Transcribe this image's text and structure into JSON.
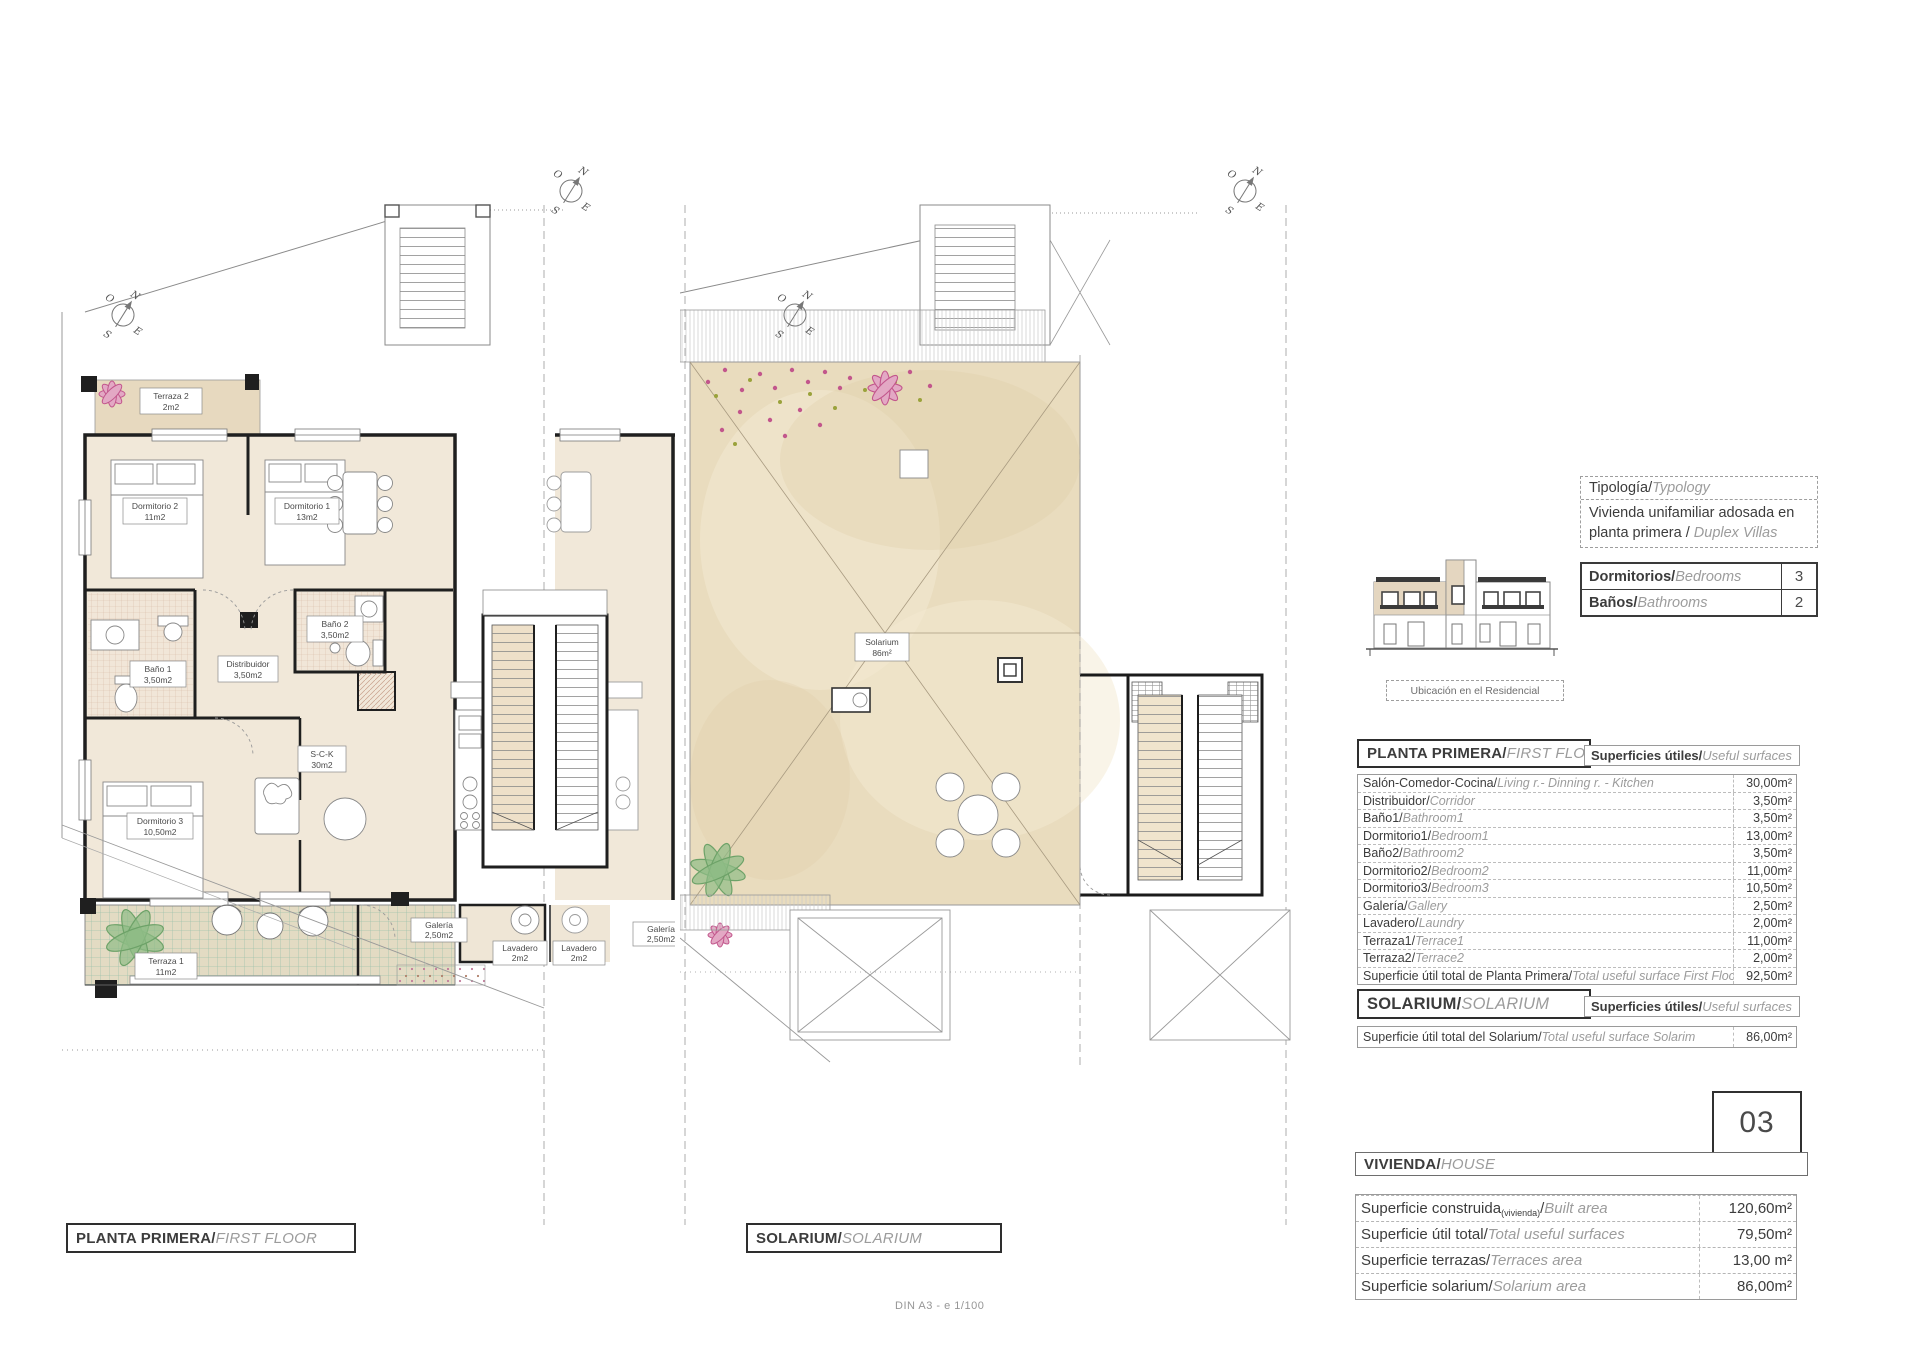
{
  "sheet": {
    "scale_note": "DIN A3 - e 1/100"
  },
  "compass": {
    "n": "N",
    "s": "S",
    "e": "E",
    "o": "O"
  },
  "plan1": {
    "title_es": "PLANTA PRIMERA/",
    "title_en": "FIRST FLOOR",
    "rooms": [
      {
        "name": "Terraza 2",
        "area": "2m2"
      },
      {
        "name": "Dormitorio 2",
        "area": "11m2"
      },
      {
        "name": "Dormitorio 1",
        "area": "13m2"
      },
      {
        "name": "Baño 1",
        "area": "3,50m2"
      },
      {
        "name": "Distribuidor",
        "area": "3,50m2"
      },
      {
        "name": "Baño 2",
        "area": "3,50m2"
      },
      {
        "name": "Dormitorio 3",
        "area": "10,50m2"
      },
      {
        "name": "S-C-K",
        "area": "30m2"
      },
      {
        "name": "Terraza 1",
        "area": "11m2"
      },
      {
        "name": "Galería",
        "area": "2,50m2"
      },
      {
        "name": "Lavadero",
        "area": "2m2"
      },
      {
        "name": "Lavadero",
        "area": "2m2"
      },
      {
        "name": "Galería",
        "area": "2,50m2"
      }
    ]
  },
  "plan2": {
    "title_es": "SOLARIUM/",
    "title_en": "SOLARIUM",
    "label_name": "Solarium",
    "label_area": "86m²"
  },
  "typology": {
    "header_es": "Tipología/",
    "header_en": "Typology",
    "line1": "Vivienda unifamiliar adosada en",
    "line2_es": "planta primera / ",
    "line2_en": "Duplex Villas"
  },
  "counts": {
    "rows": [
      {
        "es": "Dormitorios/",
        "en": "Bedrooms",
        "value": "3"
      },
      {
        "es": "Baños/",
        "en": "Bathrooms",
        "value": "2"
      }
    ]
  },
  "location_caption": "Ubicación en el Residencial",
  "first_floor": {
    "header_es": "PLANTA PRIMERA/",
    "header_en": "FIRST FLOOR",
    "surfaces_es": "Superficies útiles/",
    "surfaces_en": "Useful surfaces",
    "rows": [
      {
        "es": "Salón-Comedor-Cocina/",
        "en": "Living r.- Dinning r. - Kitchen",
        "value": "30,00m²"
      },
      {
        "es": "Distribuidor/",
        "en": "Corridor",
        "value": "3,50m²"
      },
      {
        "es": "Baño1/",
        "en": "Bathroom1",
        "value": "3,50m²"
      },
      {
        "es": "Dormitorio1/",
        "en": "Bedroom1",
        "value": "13,00m²"
      },
      {
        "es": "Baño2/",
        "en": "Bathroom2",
        "value": "3,50m²"
      },
      {
        "es": "Dormitorio2/",
        "en": "Bedroom2",
        "value": "11,00m²"
      },
      {
        "es": "Dormitorio3/",
        "en": "Bedroom3",
        "value": "10,50m²"
      },
      {
        "es": "Galería/",
        "en": "Gallery",
        "value": "2,50m²"
      },
      {
        "es": "Lavadero/",
        "en": "Laundry",
        "value": "2,00m²"
      },
      {
        "es": "Terraza1/",
        "en": "Terrace1",
        "value": "11,00m²"
      },
      {
        "es": "Terraza2/",
        "en": "Terrace2",
        "value": "2,00m²"
      }
    ],
    "total": {
      "es": "Superficie útil total de Planta Primera/",
      "en": "Total useful surface First Floor",
      "value": "92,50m²"
    }
  },
  "solarium_section": {
    "header_es": "SOLARIUM/",
    "header_en": "SOLARIUM",
    "surfaces_es": "Superficies útiles/",
    "surfaces_en": "Useful surfaces",
    "total": {
      "es": "Superficie útil total del Solarium/",
      "en": "Total useful surface Solarim",
      "value": "86,00m²"
    }
  },
  "unit_number": "03",
  "house": {
    "header_es": "VIVIENDA/",
    "header_en": "HOUSE",
    "rows": [
      {
        "es": "Superficie construida",
        "sub": "(vivienda)",
        "slash": "/",
        "en": "Built area",
        "value": "120,60m²"
      },
      {
        "es": "Superficie útil total/",
        "en": "Total useful surfaces",
        "value": "79,50m²"
      },
      {
        "es": "Superficie terrazas/",
        "en": "Terraces area",
        "value": "13,00 m²"
      },
      {
        "es": "Superficie solarium/",
        "en": "Solarium area",
        "value": "86,00m²"
      }
    ]
  }
}
